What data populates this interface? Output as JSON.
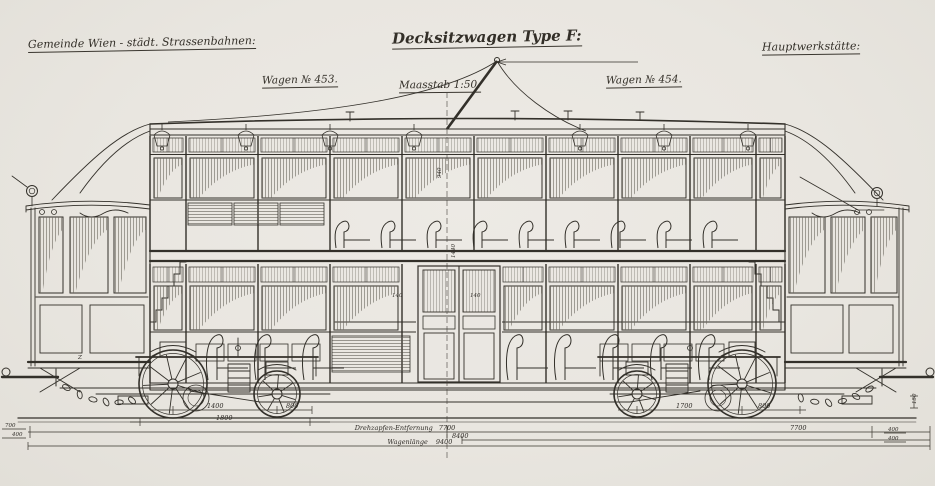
{
  "colors": {
    "paper": "#eae7e2",
    "ink": "#33302a"
  },
  "header": {
    "left": "Gemeinde Wien - städt. Strassenbahnen:",
    "title": "Decksitzwagen Type F:",
    "right": "Hauptwerkstätte:"
  },
  "sublabels": {
    "wagen_left": "Wagen № 453.",
    "scale": "Maasstab 1:50.",
    "wagen_right": "Wagen № 454."
  },
  "dims": {
    "left_wheelbase": "1400",
    "left_gap": "800",
    "left_frame": "1800",
    "right_wheelbase": "1700",
    "right_gap": "800",
    "pivot_label": "Drehzapfen-Entfernung",
    "pivot_value": "7700",
    "mid": "8400",
    "length_label": "Wagenlänge",
    "length_value": "9400",
    "edge_l1": "700",
    "edge_l2": "400",
    "edge_r1": "400",
    "edge_r2": "400",
    "edge_r3": "150",
    "v_center": "1440",
    "v_upper": "940",
    "door_a": "140",
    "door_b": "140",
    "platform_z": "Z"
  }
}
